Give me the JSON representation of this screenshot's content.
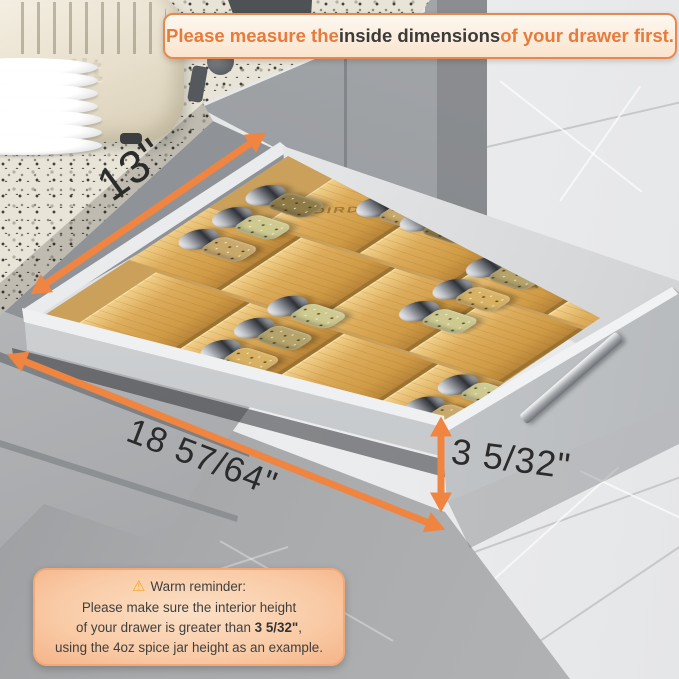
{
  "banner": {
    "part1": "Please measure the ",
    "part2": "inside dimensions",
    "part3": " of your drawer first."
  },
  "dimensions": {
    "width_top": "13\"",
    "length_bottom": "18 57/64\"",
    "height_front": "3 5/32\""
  },
  "reminder": {
    "icon": "⚠",
    "title": "Warm reminder:",
    "line1": "Please make sure the interior height",
    "line2_pre": "of your drawer is greater than ",
    "line2_bold": "3 5/32\"",
    "line2_post": ",",
    "line3": "using the 4oz spice jar height as an example."
  },
  "scene": {
    "toaster_brand": "Dualit",
    "organizer_engraving": "AADIRD"
  },
  "colors": {
    "accent_orange": "#EF8540",
    "banner_border": "#E8884C",
    "label_dark": "#2B2B2B",
    "bamboo": "#DDAD5C",
    "cabinet_gray": "#9A9DA1"
  }
}
